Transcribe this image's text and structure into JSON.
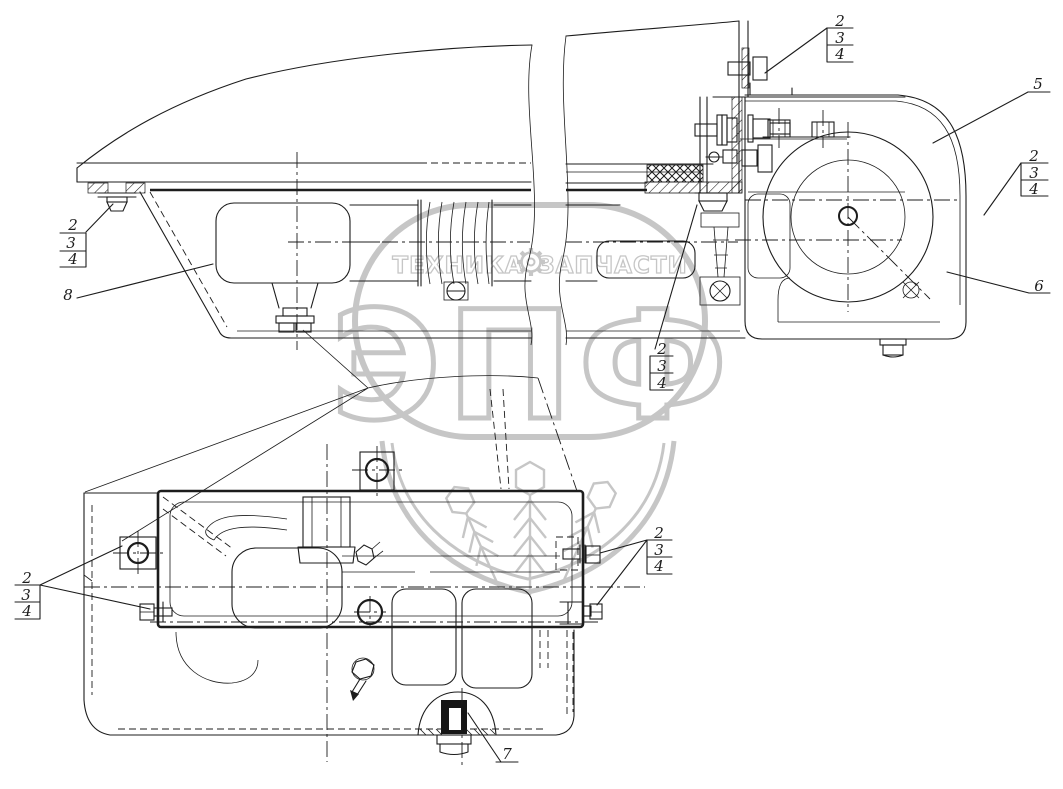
{
  "watermark": {
    "brand_left": "ТЕХНИКА",
    "brand_right": "ЗАПЧАСТИ",
    "logo": "ЭПФ"
  },
  "callouts": {
    "side_left_stack": [
      "2",
      "3",
      "4"
    ],
    "side_item_8": "8",
    "side_top_stack": [
      "2",
      "3",
      "4"
    ],
    "side_item_5": "5",
    "side_right_stack": [
      "2",
      "3",
      "4"
    ],
    "side_item_6": "6",
    "side_mid_stack": [
      "2",
      "3",
      "4"
    ],
    "plan_left_stack": [
      "2",
      "3",
      "4"
    ],
    "plan_right_stack": [
      "2",
      "3",
      "4"
    ],
    "plan_item_7": "7"
  },
  "colors": {
    "line": "#1c1c1c",
    "watermark": "#c3c3c3",
    "background": "#ffffff"
  }
}
